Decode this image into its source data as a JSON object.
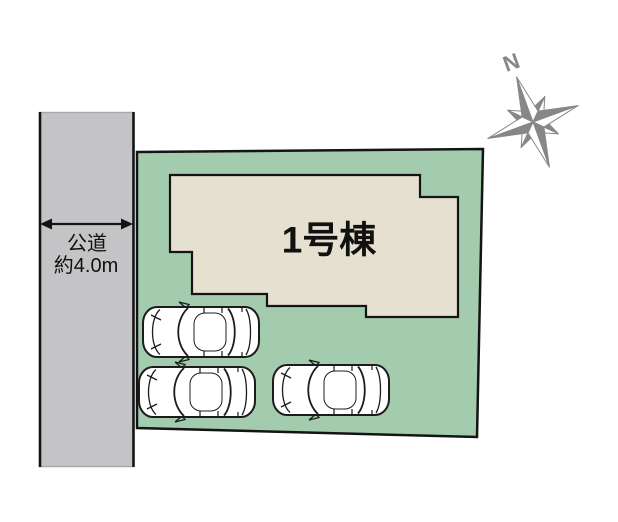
{
  "colors": {
    "plot_green": "#a3cbae",
    "building_beige": "#e6e0d0",
    "road_gray": "#c4c4c6",
    "outline": "#141414",
    "compass_gray": "#878787",
    "car_stroke": "#1c1c1c"
  },
  "road": {
    "name_label": "公道",
    "width_label": "約4.0m"
  },
  "building": {
    "label": "1号棟"
  },
  "compass": {
    "north_label": "N"
  },
  "parking": {
    "car_count": 3
  }
}
